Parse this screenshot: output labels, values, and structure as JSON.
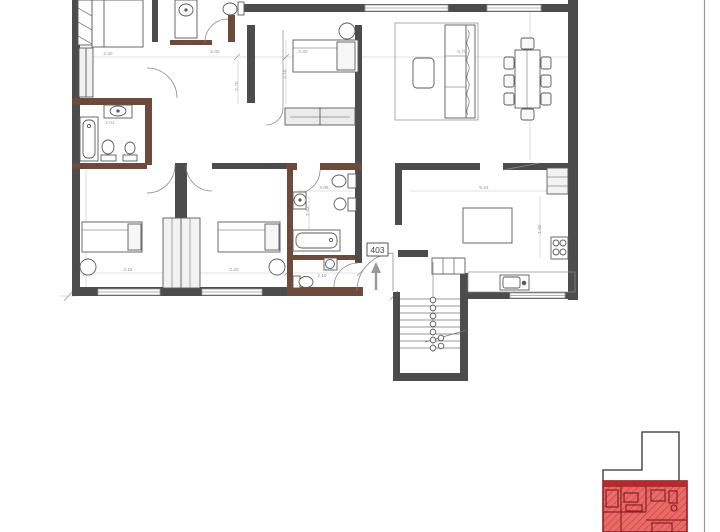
{
  "unit_label": "403",
  "dims": [
    {
      "value": "2.20"
    },
    {
      "value": "2.00"
    },
    {
      "value": "3.30"
    },
    {
      "value": "5.70"
    },
    {
      "value": "2.01"
    },
    {
      "value": "3.10"
    },
    {
      "value": "2.70"
    },
    {
      "value": "3.15"
    },
    {
      "value": "3.20"
    },
    {
      "value": "2.10"
    },
    {
      "value": "3.08"
    },
    {
      "value": "2.93"
    },
    {
      "value": "5.32"
    },
    {
      "value": "1.60"
    }
  ],
  "colors": {
    "wall": "#4c4c4c",
    "wet_wall": "#6e4a3c",
    "furniture_line": "#5a5a5a",
    "dimension_line": "#c0c0c0",
    "window": "#ffffff",
    "keyplan_highlight": "#e15555",
    "keyplan_wall": "#8e1f1f",
    "keyplan_outline": "#2f2f2f"
  }
}
